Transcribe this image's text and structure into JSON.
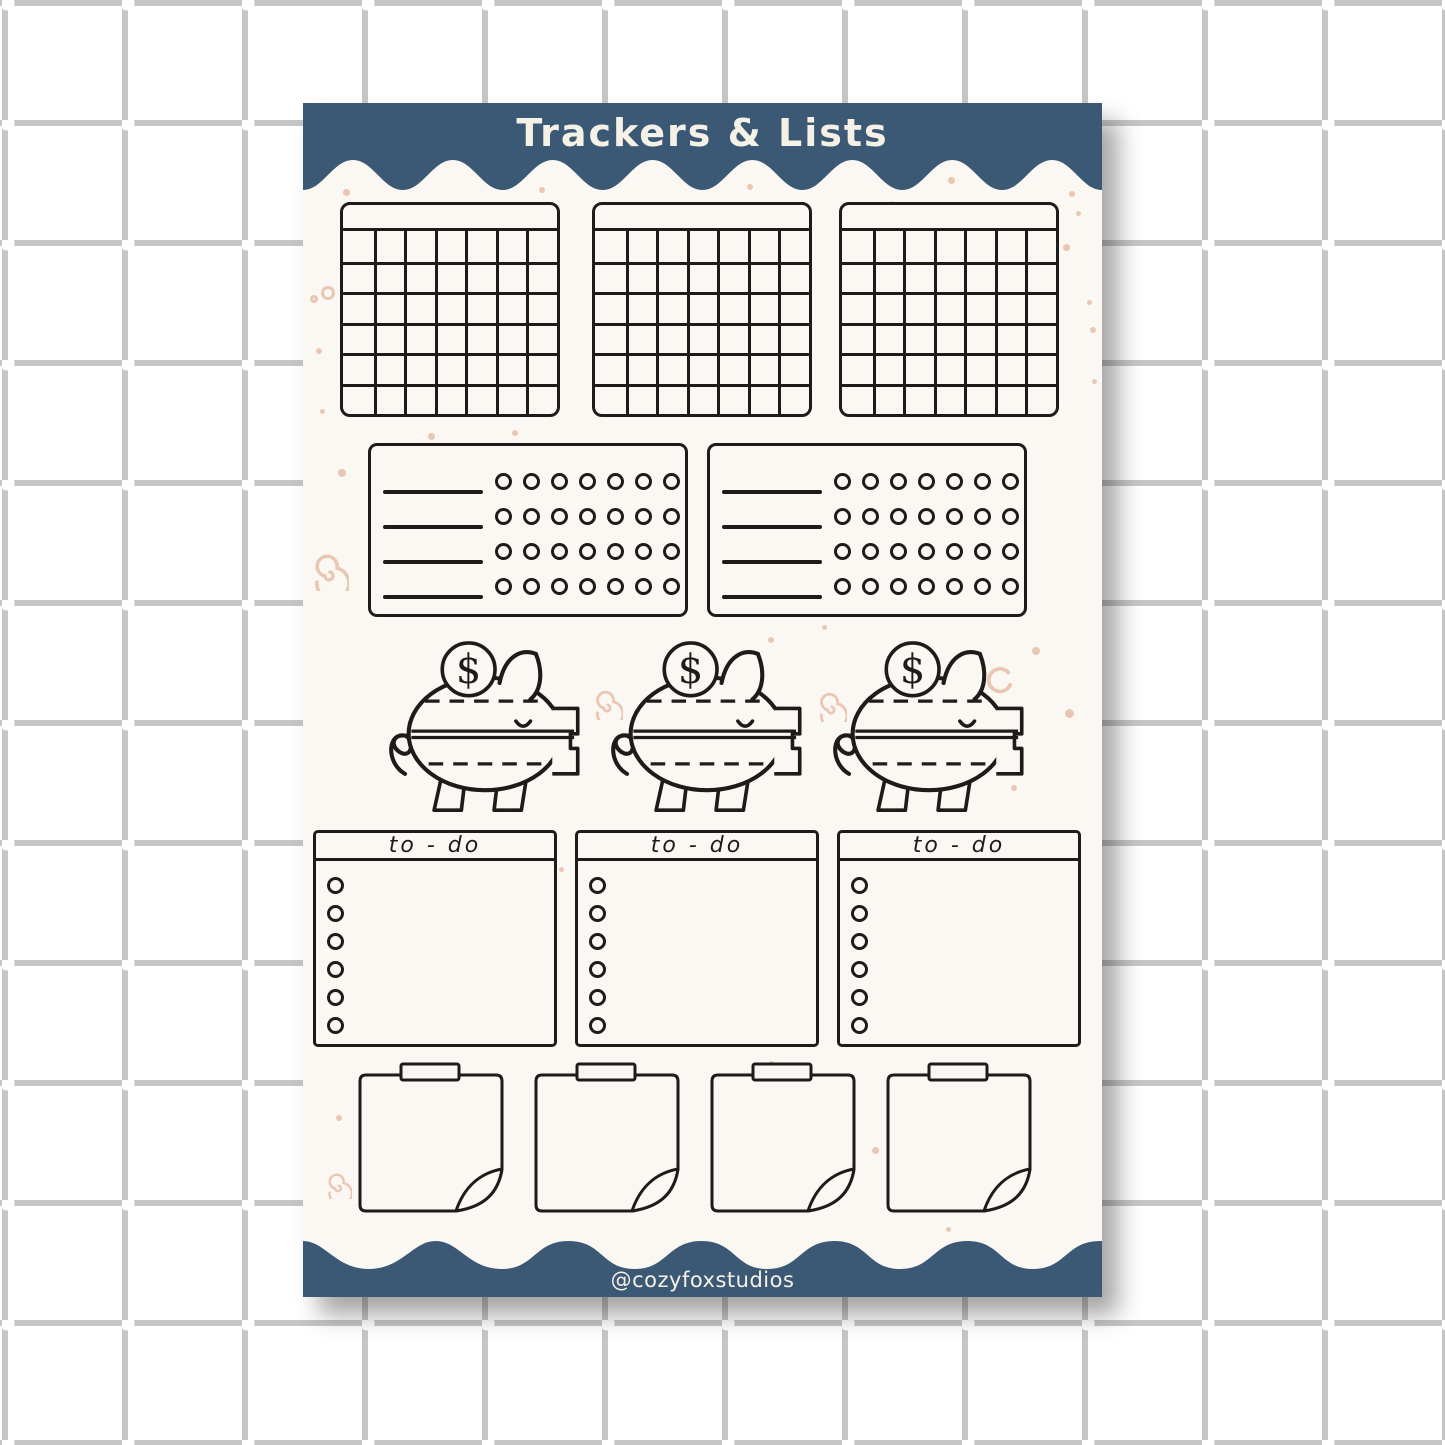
{
  "page": {
    "title_label": "Trackers & Lists",
    "credit_label": "@cozyfoxstudios"
  },
  "colors": {
    "banner_blue": "#3b5974",
    "sheet_cream": "#fbf8f3",
    "ink": "#1e1c1a",
    "doodle_peach": "#e9c7b3",
    "grid_gray": "#c6c6c6",
    "page_bg": "#ffffff",
    "banner_text": "#f6f1e7"
  },
  "stickers": {
    "calendars": {
      "count": 3,
      "columns": 7,
      "rows": 6
    },
    "habit_trackers": {
      "count": 2,
      "rows": 4,
      "circles_per_row": 7
    },
    "piggy_banks": {
      "count": 3,
      "coin_symbol": "$"
    },
    "todo_lists": {
      "count": 3,
      "header_label": "to - do",
      "circle_count": 6
    },
    "sticky_notes": {
      "count": 4
    }
  },
  "doodles": [
    {
      "t": "dot",
      "x": 40,
      "y": 86,
      "s": 7
    },
    {
      "t": "dot",
      "x": 236,
      "y": 84,
      "s": 6
    },
    {
      "t": "dot",
      "x": 444,
      "y": 81,
      "s": 6
    },
    {
      "t": "dot",
      "x": 645,
      "y": 74,
      "s": 7
    },
    {
      "t": "dot",
      "x": 766,
      "y": 88,
      "s": 6
    },
    {
      "t": "dot",
      "x": 600,
      "y": 138,
      "s": 7
    },
    {
      "t": "dash",
      "x": 573,
      "y": 104,
      "s": 12,
      "r": 70
    },
    {
      "t": "dash",
      "x": 584,
      "y": 102,
      "s": 12,
      "r": 70
    },
    {
      "t": "ring",
      "x": 18,
      "y": 183,
      "s": 14
    },
    {
      "t": "ring",
      "x": 7,
      "y": 192,
      "s": 8
    },
    {
      "t": "sparkle",
      "x": 221,
      "y": 170,
      "s": 24
    },
    {
      "t": "dot",
      "x": 13,
      "y": 245,
      "s": 6
    },
    {
      "t": "dot",
      "x": 17,
      "y": 306,
      "s": 5
    },
    {
      "t": "dot",
      "x": 35,
      "y": 366,
      "s": 8
    },
    {
      "t": "dot",
      "x": 125,
      "y": 330,
      "s": 7
    },
    {
      "t": "dot",
      "x": 209,
      "y": 327,
      "s": 6
    },
    {
      "t": "dot",
      "x": 773,
      "y": 108,
      "s": 5
    },
    {
      "t": "dot",
      "x": 760,
      "y": 141,
      "s": 7
    },
    {
      "t": "dot",
      "x": 784,
      "y": 197,
      "s": 5
    },
    {
      "t": "dot",
      "x": 787,
      "y": 224,
      "s": 6
    },
    {
      "t": "dot",
      "x": 789,
      "y": 276,
      "s": 5
    },
    {
      "t": "spiral",
      "x": 6,
      "y": 448,
      "s": 40
    },
    {
      "t": "dash",
      "x": 293,
      "y": 358,
      "s": 15,
      "r": -38
    },
    {
      "t": "dash",
      "x": 308,
      "y": 349,
      "s": 13,
      "r": -80
    },
    {
      "t": "dash",
      "x": 324,
      "y": 354,
      "s": 14,
      "r": 34
    },
    {
      "t": "sparkle",
      "x": 478,
      "y": 350,
      "s": 17
    },
    {
      "t": "dash",
      "x": 494,
      "y": 366,
      "s": 13,
      "r": 20
    },
    {
      "t": "dot",
      "x": 465,
      "y": 534,
      "s": 6
    },
    {
      "t": "dot",
      "x": 519,
      "y": 522,
      "s": 5
    },
    {
      "t": "dot",
      "x": 729,
      "y": 544,
      "s": 8
    },
    {
      "t": "dot",
      "x": 762,
      "y": 606,
      "s": 9
    },
    {
      "t": "dot",
      "x": 708,
      "y": 682,
      "s": 6
    },
    {
      "t": "spiral",
      "x": 288,
      "y": 585,
      "s": 32
    },
    {
      "t": "spiral",
      "x": 512,
      "y": 587,
      "s": 32
    },
    {
      "t": "carc",
      "x": 681,
      "y": 563,
      "s": 30
    },
    {
      "t": "dot",
      "x": 256,
      "y": 764,
      "s": 5
    },
    {
      "t": "dot",
      "x": 33,
      "y": 1012,
      "s": 6
    },
    {
      "t": "dot",
      "x": 569,
      "y": 1044,
      "s": 7
    },
    {
      "t": "spiral",
      "x": 21,
      "y": 1068,
      "s": 28
    },
    {
      "t": "dot",
      "x": 120,
      "y": 1139,
      "s": 7
    },
    {
      "t": "dot",
      "x": 253,
      "y": 1144,
      "s": 6
    },
    {
      "t": "dot",
      "x": 542,
      "y": 1148,
      "s": 10
    },
    {
      "t": "dot",
      "x": 643,
      "y": 1124,
      "s": 5
    },
    {
      "t": "dot",
      "x": 466,
      "y": 958,
      "s": 5
    },
    {
      "t": "dot",
      "x": 700,
      "y": 980,
      "s": 6
    }
  ]
}
